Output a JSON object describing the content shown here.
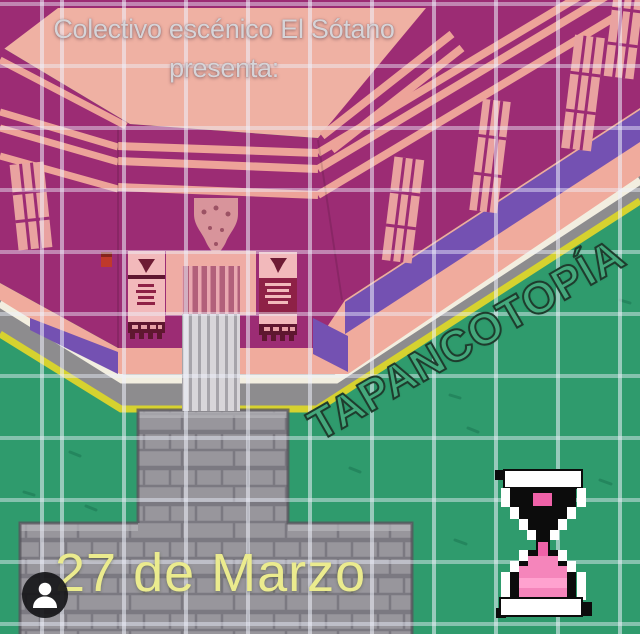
{
  "poster": {
    "presenter_line1": "Colectivo escénico El Sótano",
    "presenter_line2": "presenta:",
    "title": "TAPANCOTOPÍA",
    "date": "27 de Marzo"
  },
  "icons": {
    "hourglass": "hourglass-icon",
    "profile_badge": "person-badge-icon"
  },
  "colors": {
    "roof_salmon": "#efb1a3",
    "wall_magenta": "#9c2c74",
    "trim_pink": "#eda399",
    "violet_shadow": "#7451b2",
    "sidewalk_gray": "#8d8c8e",
    "sidewalk_edge_white": "#f2eee0",
    "curb_yellow": "#d6d22f",
    "grass_green": "#2f9b6d",
    "path_gray": "#98969c",
    "banner_pink": "#f2b9bb",
    "banner_maroon": "#8e2146",
    "title_green": "#44a87c",
    "date_yellow": "#ebeb8e",
    "header_gray": "#d6d4d8",
    "sand_pink": "#f585bb"
  }
}
